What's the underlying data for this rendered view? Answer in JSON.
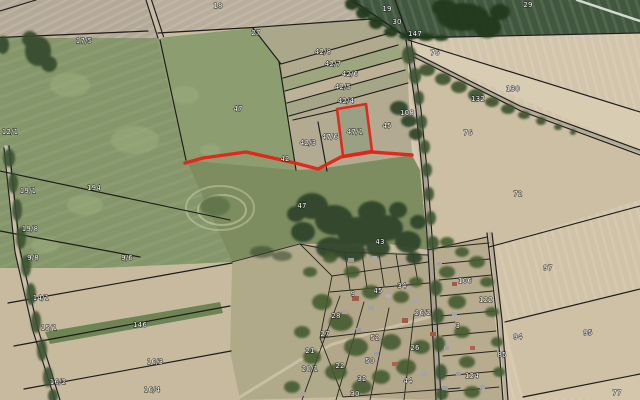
{
  "map": {
    "description": "Aerial orthophoto with cadastral parcel boundaries and a highlighted parcel with access route",
    "highlighted_parcel": "47/1",
    "highlight_color": "#e42318",
    "boundary_color": "#1c1c1a",
    "label_text_color": "#ffffff",
    "parcel_labels": [
      {
        "x": 84,
        "y": 43,
        "label": "17/5"
      },
      {
        "x": 218,
        "y": 8,
        "label": "18"
      },
      {
        "x": 256,
        "y": 35,
        "label": "27"
      },
      {
        "x": 387,
        "y": 11,
        "label": "19"
      },
      {
        "x": 397,
        "y": 24,
        "label": "30"
      },
      {
        "x": 415,
        "y": 36,
        "label": "147"
      },
      {
        "x": 528,
        "y": 7,
        "label": "29"
      },
      {
        "x": 435,
        "y": 55,
        "label": "76"
      },
      {
        "x": 513,
        "y": 91,
        "label": "130"
      },
      {
        "x": 478,
        "y": 101,
        "label": "132"
      },
      {
        "x": 468,
        "y": 135,
        "label": "76"
      },
      {
        "x": 518,
        "y": 196,
        "label": "72"
      },
      {
        "x": 323,
        "y": 54,
        "label": "42/8"
      },
      {
        "x": 333,
        "y": 66,
        "label": "42/7"
      },
      {
        "x": 350,
        "y": 76,
        "label": "42/6"
      },
      {
        "x": 343,
        "y": 89,
        "label": "42/5"
      },
      {
        "x": 346,
        "y": 103,
        "label": "42/4"
      },
      {
        "x": 308,
        "y": 145,
        "label": "42/3"
      },
      {
        "x": 330,
        "y": 139,
        "label": "47/6"
      },
      {
        "x": 355,
        "y": 134,
        "label": "47/1"
      },
      {
        "x": 387,
        "y": 128,
        "label": "45"
      },
      {
        "x": 407,
        "y": 115,
        "label": "108"
      },
      {
        "x": 285,
        "y": 161,
        "label": "42"
      },
      {
        "x": 238,
        "y": 111,
        "label": "47"
      },
      {
        "x": 302,
        "y": 208,
        "label": "47"
      },
      {
        "x": 380,
        "y": 244,
        "label": "43"
      },
      {
        "x": 10,
        "y": 134,
        "label": "12/1"
      },
      {
        "x": 28,
        "y": 193,
        "label": "19/1"
      },
      {
        "x": 94,
        "y": 190,
        "label": "194"
      },
      {
        "x": 30,
        "y": 231,
        "label": "19/8"
      },
      {
        "x": 33,
        "y": 260,
        "label": "9/8"
      },
      {
        "x": 127,
        "y": 260,
        "label": "9/6"
      },
      {
        "x": 41,
        "y": 300,
        "label": "14/1"
      },
      {
        "x": 49,
        "y": 330,
        "label": "15/1"
      },
      {
        "x": 140,
        "y": 327,
        "label": "146"
      },
      {
        "x": 155,
        "y": 364,
        "label": "16/3"
      },
      {
        "x": 58,
        "y": 384,
        "label": "16/2"
      },
      {
        "x": 152,
        "y": 392,
        "label": "16/4"
      },
      {
        "x": 548,
        "y": 270,
        "label": "97"
      },
      {
        "x": 588,
        "y": 335,
        "label": "95"
      },
      {
        "x": 518,
        "y": 339,
        "label": "94"
      },
      {
        "x": 502,
        "y": 357,
        "label": "85"
      },
      {
        "x": 486,
        "y": 302,
        "label": "122"
      },
      {
        "x": 465,
        "y": 283,
        "label": "106"
      },
      {
        "x": 472,
        "y": 378,
        "label": "124"
      },
      {
        "x": 617,
        "y": 395,
        "label": "77"
      },
      {
        "x": 353,
        "y": 296,
        "label": "9"
      },
      {
        "x": 378,
        "y": 293,
        "label": "45"
      },
      {
        "x": 402,
        "y": 288,
        "label": "34"
      },
      {
        "x": 423,
        "y": 315,
        "label": "26/2"
      },
      {
        "x": 336,
        "y": 318,
        "label": "28"
      },
      {
        "x": 325,
        "y": 336,
        "label": "27"
      },
      {
        "x": 310,
        "y": 353,
        "label": "21"
      },
      {
        "x": 310,
        "y": 371,
        "label": "20/1"
      },
      {
        "x": 340,
        "y": 368,
        "label": "22"
      },
      {
        "x": 375,
        "y": 340,
        "label": "52"
      },
      {
        "x": 370,
        "y": 363,
        "label": "50"
      },
      {
        "x": 362,
        "y": 381,
        "label": "32"
      },
      {
        "x": 415,
        "y": 350,
        "label": "26"
      },
      {
        "x": 408,
        "y": 383,
        "label": "44"
      },
      {
        "x": 355,
        "y": 396,
        "label": "30"
      },
      {
        "x": 458,
        "y": 328,
        "label": "3"
      }
    ]
  }
}
